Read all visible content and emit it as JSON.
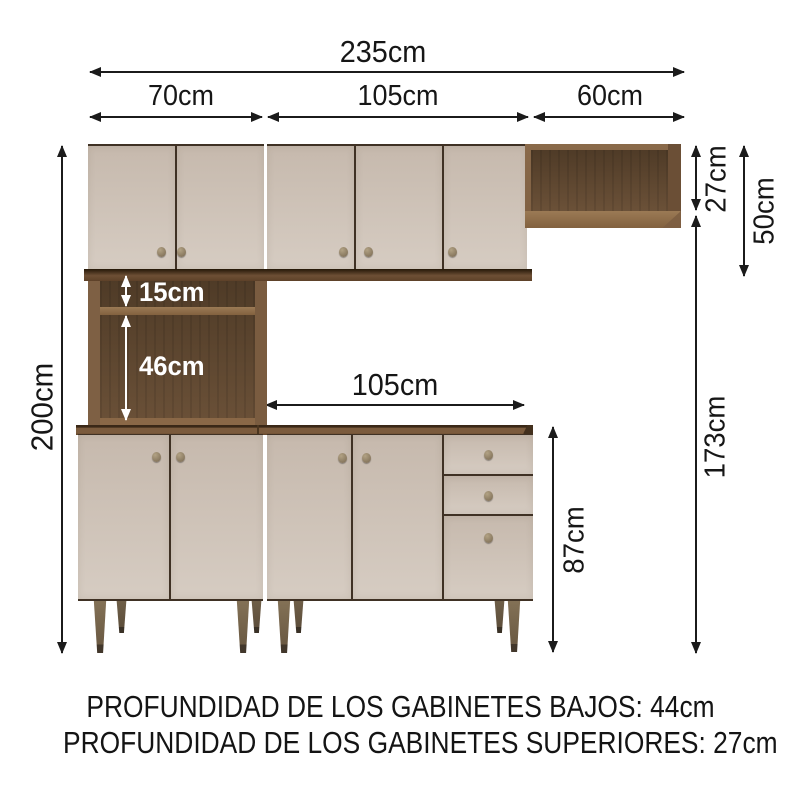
{
  "dims": {
    "total_width": "235cm",
    "upper_left_width": "70cm",
    "upper_middle_width": "105cm",
    "wall_shelf_width": "60cm",
    "total_height": "200cm",
    "wall_shelf_height": "27cm",
    "upper_cabinet_height": "50cm",
    "wall_shelf_to_floor": "173cm",
    "counter_width": "105cm",
    "base_cabinet_height": "87cm",
    "niche_upper_height": "15cm",
    "niche_lower_height": "46cm"
  },
  "footer": {
    "line1": "PROFUNDIDAD DE LOS GABINETES BAJOS: 44cm",
    "line2": "PROFUNDIDAD DE LOS GABINETES SUPERIORES: 27cm"
  },
  "colors": {
    "door_front": "#cfc4b9",
    "wood_frame": "#7d5e41",
    "wood_interior": "#4a3827",
    "countertop": "#7b5b3d",
    "dimension_line": "#1b1b1b",
    "dimension_text_light": "#ffffff"
  }
}
